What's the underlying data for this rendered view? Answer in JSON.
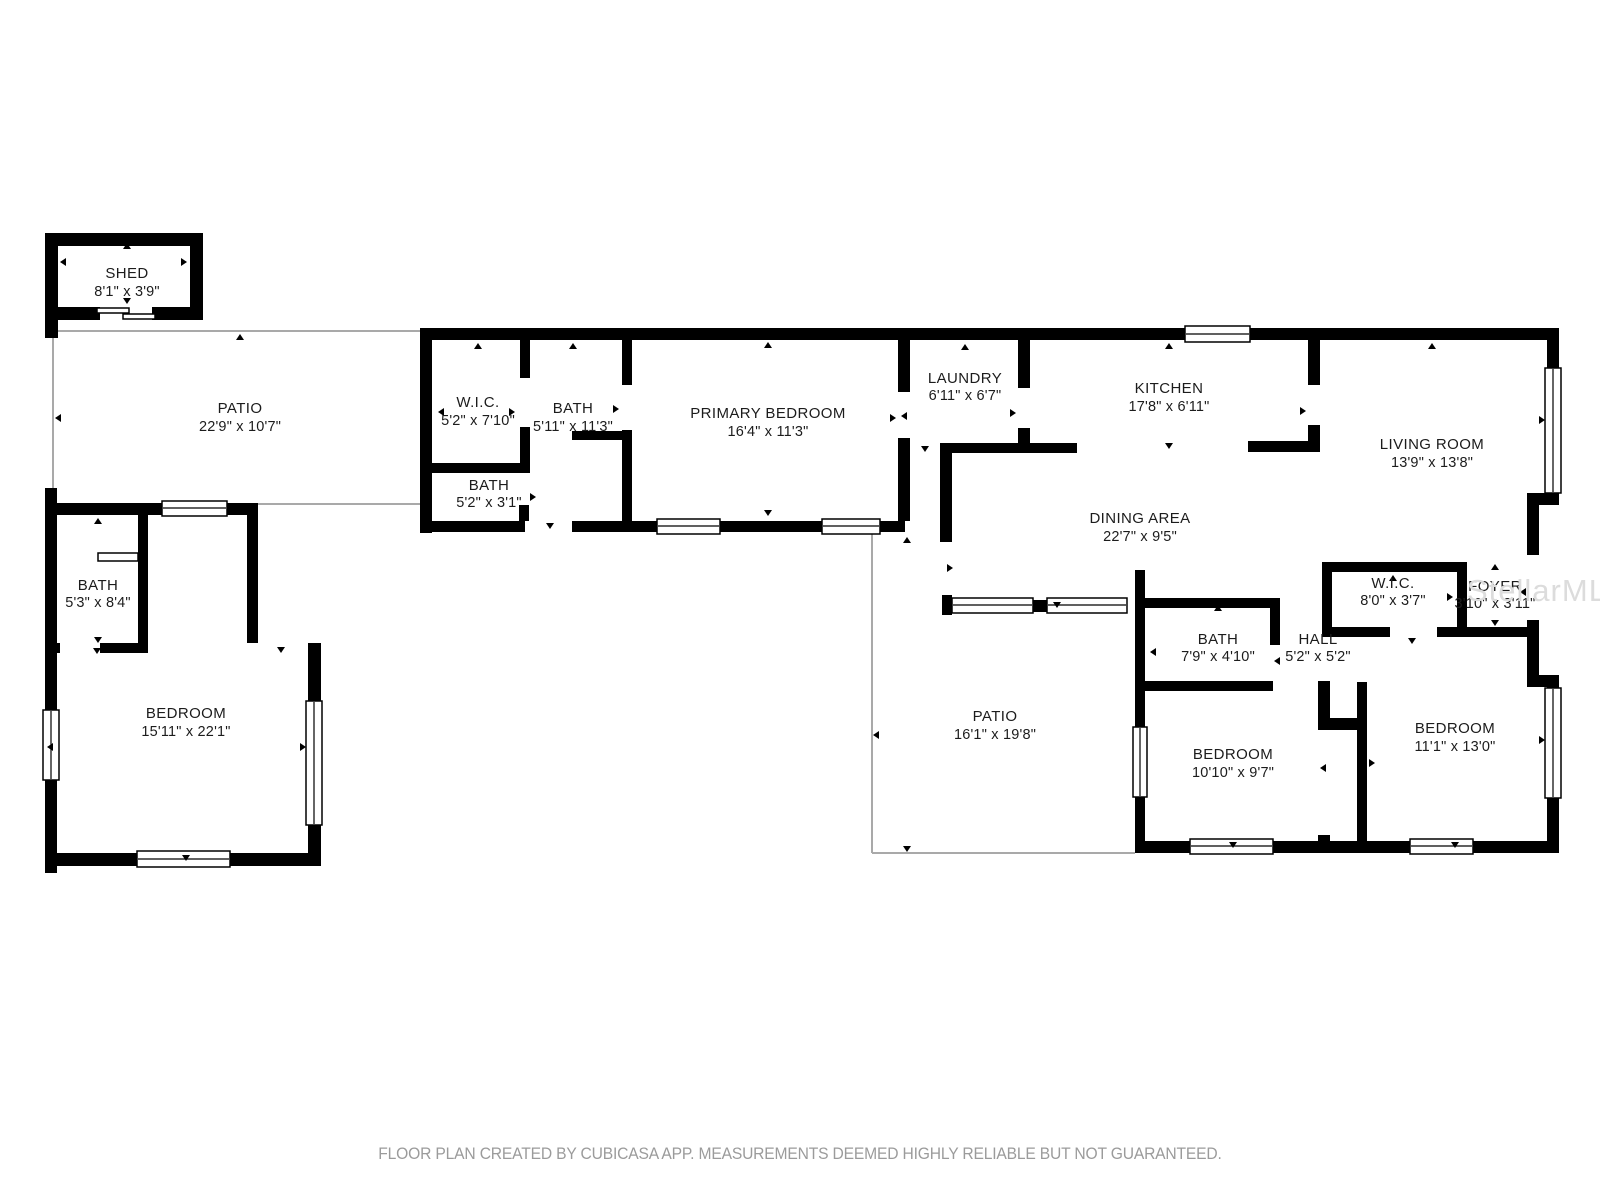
{
  "plan": {
    "rooms": [
      {
        "name": "SHED",
        "dims": "8'1\" x 3'9\""
      },
      {
        "name": "PATIO",
        "dims": "22'9\" x 10'7\""
      },
      {
        "name": "W.I.C.",
        "dims": "5'2\" x 7'10\""
      },
      {
        "name": "BATH",
        "dims": "5'11\" x 11'3\""
      },
      {
        "name": "BATH",
        "dims": "5'2\" x 3'1\""
      },
      {
        "name": "PRIMARY BEDROOM",
        "dims": "16'4\" x 11'3\""
      },
      {
        "name": "LAUNDRY",
        "dims": "6'11\" x 6'7\""
      },
      {
        "name": "KITCHEN",
        "dims": "17'8\" x 6'11\""
      },
      {
        "name": "LIVING ROOM",
        "dims": "13'9\" x 13'8\""
      },
      {
        "name": "DINING AREA",
        "dims": "22'7\" x 9'5\""
      },
      {
        "name": "BATH",
        "dims": "5'3\" x 8'4\""
      },
      {
        "name": "BEDROOM",
        "dims": "15'11\" x 22'1\""
      },
      {
        "name": "W.I.C.",
        "dims": "8'0\" x 3'7\""
      },
      {
        "name": "FOYER",
        "dims": "3'10\" x 3'11\""
      },
      {
        "name": "BATH",
        "dims": "7'9\" x 4'10\""
      },
      {
        "name": "HALL",
        "dims": "5'2\" x 5'2\""
      },
      {
        "name": "PATIO",
        "dims": "16'1\" x 19'8\""
      },
      {
        "name": "BEDROOM",
        "dims": "10'10\" x 9'7\""
      },
      {
        "name": "BEDROOM",
        "dims": "11'1\" x 13'0\""
      }
    ],
    "footer": {
      "text": "FLOOR PLAN CREATED BY CUBICASA APP. MEASUREMENTS DEEMED HIGHLY RELIABLE BUT NOT GUARANTEED."
    },
    "watermark": {
      "text": "StellarMLS"
    },
    "colors": {
      "wall": "#000000",
      "thin_line": "#a9a9a9",
      "label": "#1c1c1c",
      "footer": "#9b9b9b",
      "watermark": "#dcdcdc"
    }
  }
}
